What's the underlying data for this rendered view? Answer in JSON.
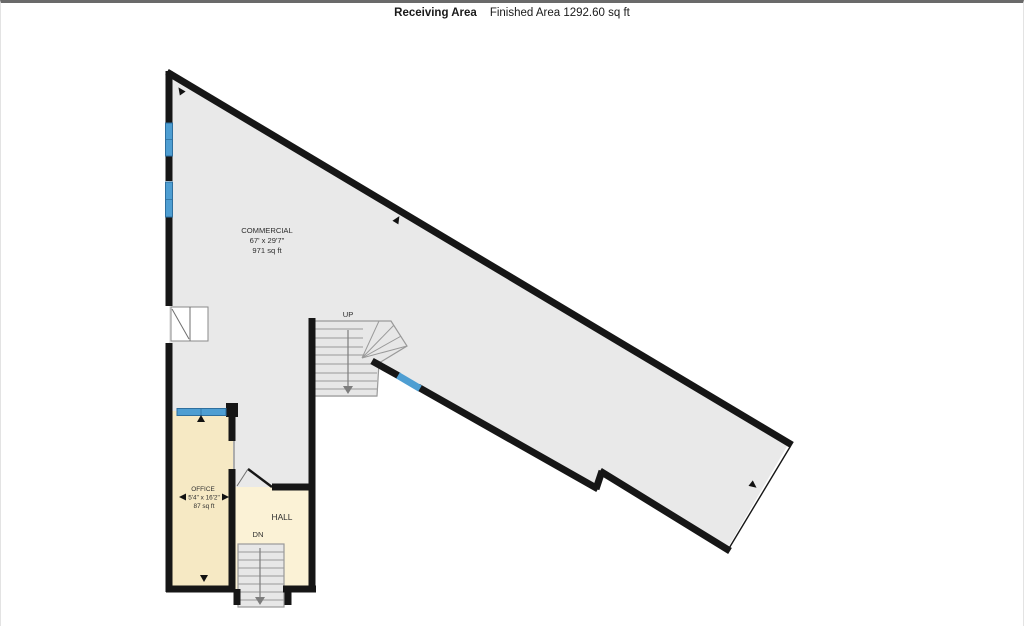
{
  "header": {
    "title": "Receiving Area",
    "subtitle": "Finished Area 1292.60 sq ft"
  },
  "rooms": {
    "commercial": {
      "name": "COMMERCIAL",
      "dimensions": "67' x 29'7\"",
      "area": "971 sq ft"
    },
    "office": {
      "name": "OFFICE",
      "dimensions": "5'4\" x 16'2\"",
      "area": "87 sq ft"
    },
    "hall": {
      "name": "HALL"
    }
  },
  "stairs": {
    "up_label": "UP",
    "down_label": "DN"
  },
  "colors": {
    "wall": "#161616",
    "commercial_fill": "#e9e9e9",
    "office_fill": "#f6e9c4",
    "hall_fill": "#fbf2d6",
    "window": "#4e9ed2",
    "stair_fill": "#e7e7e7",
    "stair_line": "#9a9a9a"
  }
}
